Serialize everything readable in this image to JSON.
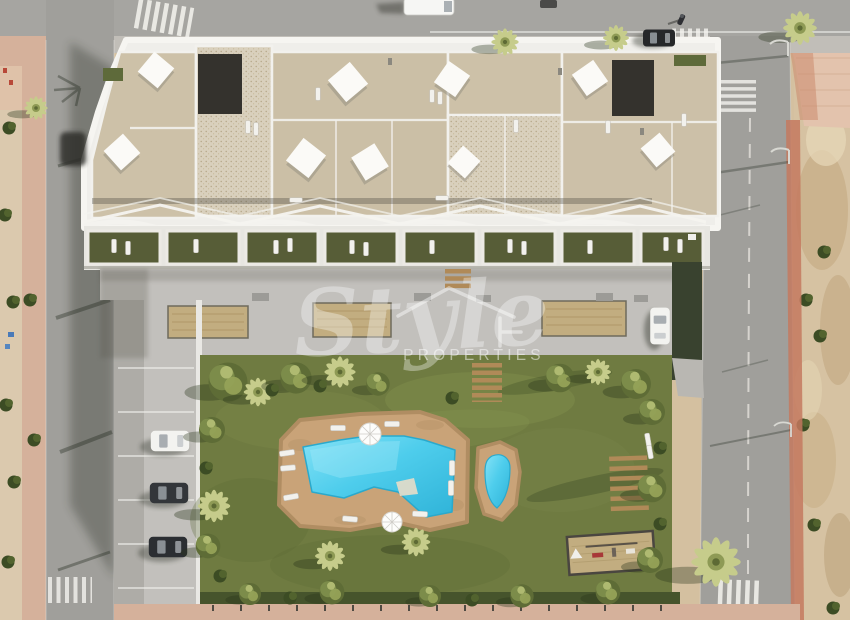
{
  "meta": {
    "type": "aerial-3d-render",
    "description": "Top-down aerial 3D render of a new-build apartment complex with rooftop solarium terraces, private garden terraces, a communal paved deck, landscaped lawn with free-form pool and kids pool, street parking and surrounding roads with an undeveloped sandy plot to the right."
  },
  "watermark": {
    "brand_script": "Style",
    "brand_caps": "PROPERTIES",
    "icon": "house-outline-icon",
    "color": "#ffffff"
  },
  "palette": {
    "sand": "#d4c0a0",
    "sand_dark": "#c0a87f",
    "asphalt": "#a09f9b",
    "asphalt_top": "#a6a5a1",
    "shadow": "#20261a",
    "sidewalk_pink": "#d5b19b",
    "bike_lane": "#c4795f",
    "concrete": "#c2c0bc",
    "white_trim": "#efeeea",
    "roof_beige": "#cdc1a8",
    "roof_stone": "#d9d0bd",
    "roof_dark": "#34322d",
    "terrace_lawn": "#575d37",
    "lawn": "#6f7b41",
    "hedge": "#46542c",
    "tree_light": "#c6cc8b",
    "pool_water": "#4ecdec",
    "pool_deck": "#c9a378",
    "wood": "#b08a58",
    "playground_sand": "#c2ad80",
    "car_dark": "#33363a",
    "car_white": "#f3f3f0"
  },
  "scene": {
    "roads": [
      "top-road",
      "left-road",
      "right-road"
    ],
    "crosswalks": [
      "top-left-crosswalk",
      "junction-crosswalk",
      "right-road-upper-crosswalk",
      "right-road-lower-crosswalk",
      "left-road-lower-crosswalk"
    ],
    "vehicles": [
      "white-van",
      "dark-vehicle-top-edge",
      "motorcycle",
      "parked-dark-car",
      "courtyard-white-car",
      "parking-white-car",
      "parking-dark-car-1",
      "parking-dark-car-2"
    ],
    "amenities": [
      "main-pool",
      "kids-pool",
      "sun-loungers",
      "parasols",
      "shade-sails",
      "rooftop-solariums",
      "private-terrace-gardens",
      "communal-deck",
      "sand-planters",
      "wooden-benches",
      "wooden-steps",
      "playground",
      "garden-lawn",
      "palm-trees",
      "parking-bays",
      "street-lamps"
    ],
    "environment": [
      "sandy-vacant-lot",
      "pink-sidewalks",
      "red-bike-lane",
      "hedges",
      "building-shadows"
    ]
  }
}
